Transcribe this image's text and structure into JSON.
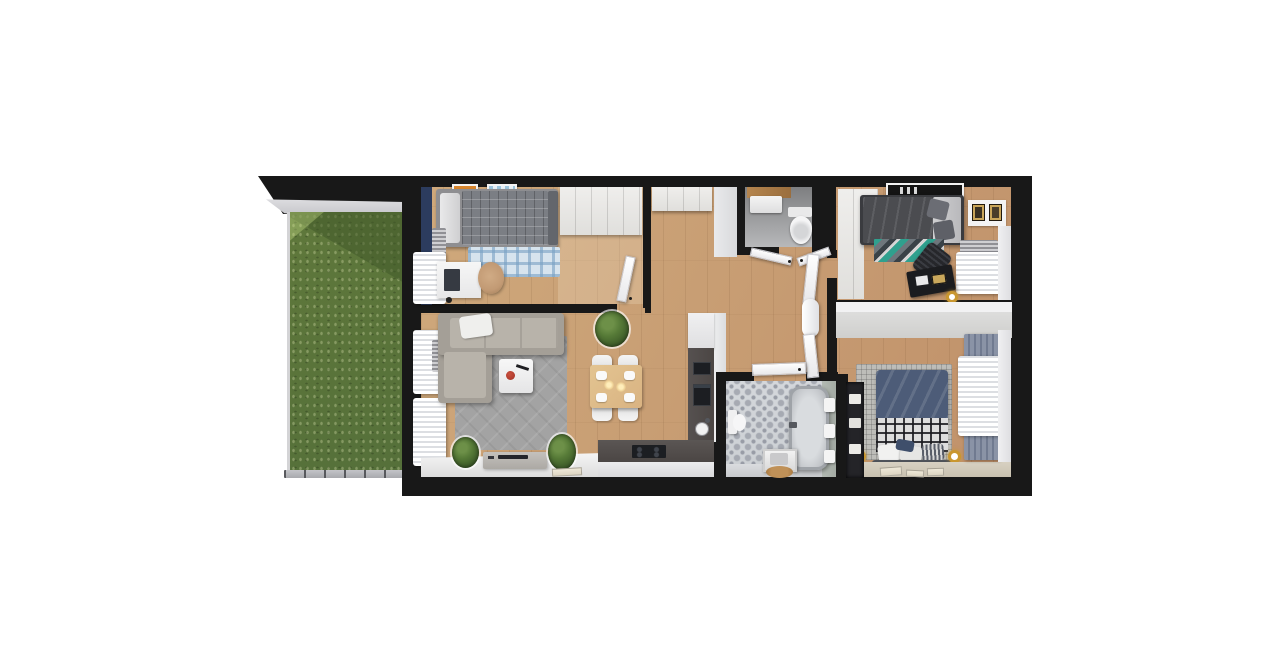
{
  "scene": {
    "type": "3d-floor-plan-render",
    "view": "top-down",
    "background": "#ffffff",
    "text_visible": "none"
  },
  "palette": {
    "wall": "#181818",
    "wood": "#c0916a",
    "wood_light": "#cfa97c",
    "grass": "#5f783b",
    "grass_shadow": "#42592a",
    "navy_wall": "#2c3c5e",
    "sofa": "#a49f97",
    "sofa_light": "#b8b3aa",
    "rug_gray": "#a3a3a3",
    "rug_blue": "#d7e4ee",
    "rug_blue_line": "#8fb4cc",
    "teal": "#2fa08e",
    "bed_dark": "#4b4c50",
    "bed_navy": "#4d5c78",
    "counter_dark": "#4b4644",
    "appliance_black": "#1c1e22",
    "table_wood": "#d9b382",
    "tile_base": "#ccd0d4",
    "tile_dot": "#989ca6",
    "chair_tan": "#c29a74",
    "gold": "#c9972f",
    "red_accent": "#a33327",
    "drape_blue": "#8a93a6",
    "wc_floor": "#9a9a9a",
    "art_orange": "#d8862e",
    "art_blue": "#9cc4dd"
  },
  "rooms": [
    {
      "name": "garden-terrace",
      "features": [
        "lawn",
        "roof-overhang",
        "fence"
      ]
    },
    {
      "name": "bedroom-left",
      "furniture": [
        "single-bed",
        "blue-plaid-rug",
        "desk",
        "tan-chair",
        "wardrobe",
        "two-wall-art-frames",
        "window-curtain",
        "radiator",
        "navy-accent-wall",
        "door"
      ]
    },
    {
      "name": "living-room-with-kitchen",
      "furniture": [
        "corner-sofa",
        "gray-rug",
        "coffee-table",
        "red-bowl",
        "potted-plant",
        "dining-table",
        "four-dining-chairs",
        "tv-cabinet",
        "two-plants",
        "kitchen-counter",
        "induction-hob",
        "oven-column",
        "round-sink",
        "two-window-curtains"
      ]
    },
    {
      "name": "hallway",
      "furniture": [
        "built-in-cabinet",
        "open-doors",
        "entrance-door"
      ]
    },
    {
      "name": "wc",
      "furniture": [
        "toilet",
        "washbasin",
        "wood-shelf"
      ]
    },
    {
      "name": "bedroom-right-top",
      "furniture": [
        "double-bed",
        "teal-zigzag-rug",
        "black-desk",
        "office-chair",
        "wardrobe",
        "black-wall-art",
        "two-picture-frames",
        "window-curtain",
        "radiator",
        "gold-lamp"
      ]
    },
    {
      "name": "bathroom",
      "furniture": [
        "bathtub",
        "toilet",
        "vanity-cabinet",
        "wood-mat",
        "three-towels",
        "ornament-tile-floor",
        "linen-niche"
      ]
    },
    {
      "name": "bedroom-right-bottom",
      "furniture": [
        "double-bed-navy",
        "black-white-plaid-blanket",
        "pillows",
        "two-gold-bedside-lamps",
        "gray-rug",
        "window-drapes",
        "books-on-floor"
      ]
    }
  ]
}
